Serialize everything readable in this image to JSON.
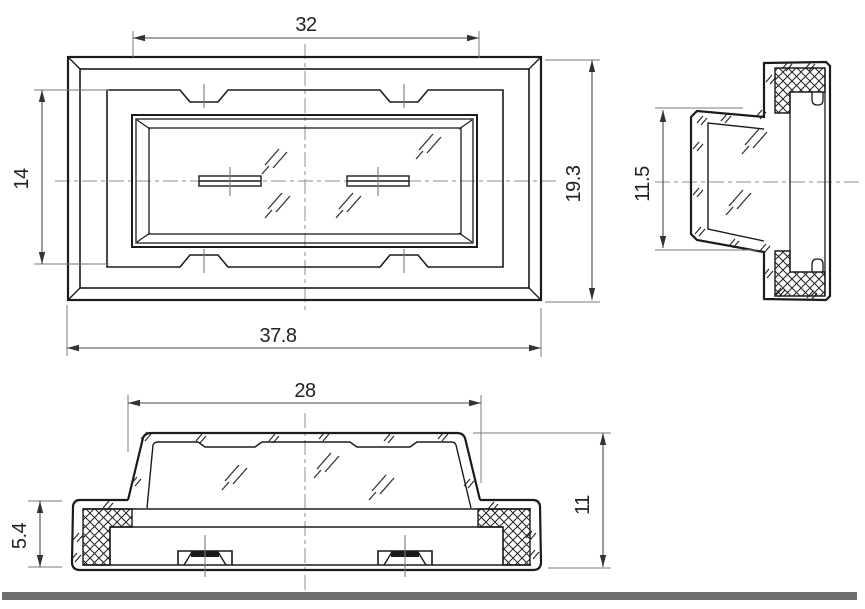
{
  "drawing": {
    "dimensions": {
      "front_width_inner": "32",
      "front_height_inner": "14",
      "front_height_outer": "19.3",
      "front_width_outer": "37.8",
      "side_lens_height": "11.5",
      "bottom_lens_width": "28",
      "bottom_flange_height": "5.4",
      "bottom_total_height": "11"
    },
    "colors": {
      "line": "#1b1b1b",
      "dim_line": "#4a4a4a",
      "extension_line": "#7a7a7a",
      "centerline": "#8f8f8f",
      "footer_bar": "#6f6f6f",
      "background": "#ffffff"
    }
  }
}
